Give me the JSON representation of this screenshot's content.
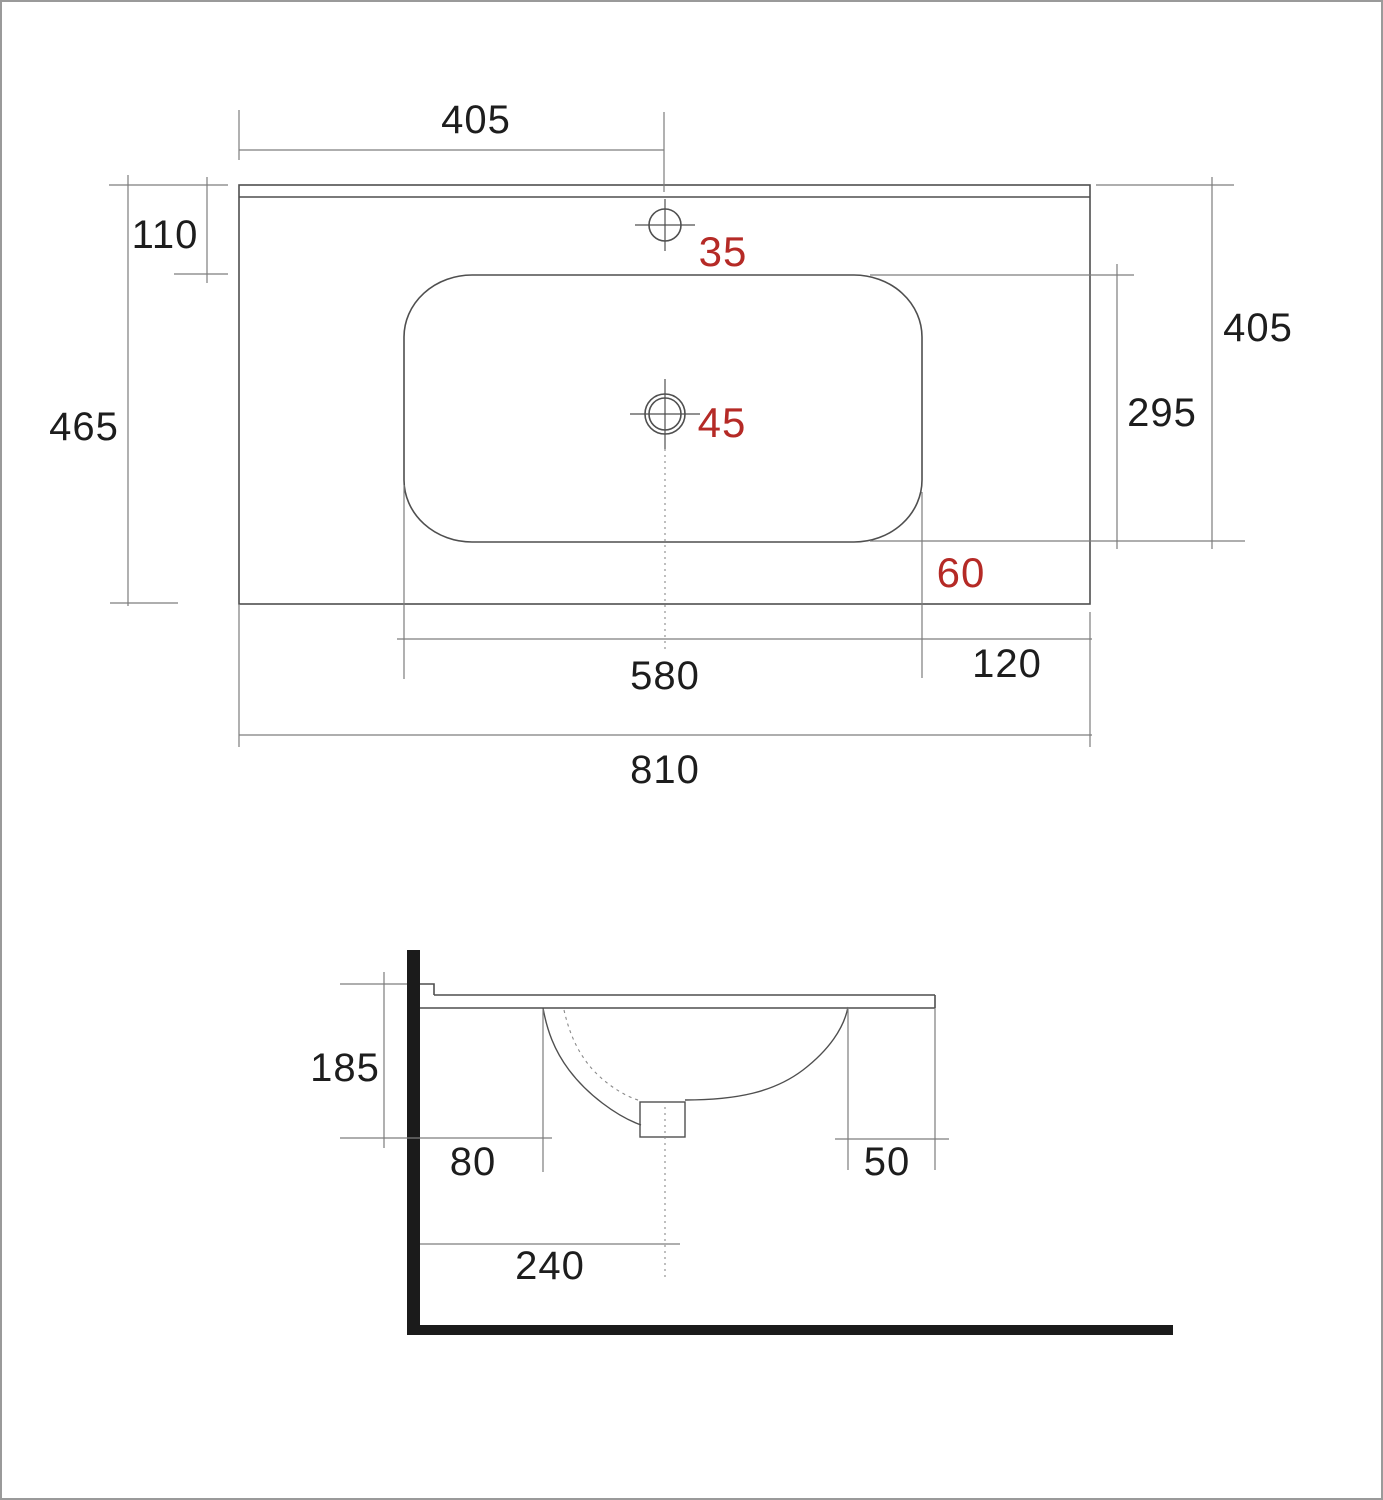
{
  "drawing": {
    "title": "Washbasin technical dimension drawing",
    "views": [
      "top-view",
      "side-section-view"
    ],
    "units_shown": "none (mm implied)"
  },
  "colors": {
    "background": "#ffffff",
    "outline": "#4f4f4f",
    "dimension_line": "#7d7d7d",
    "accent_red": "#b52a26",
    "wall_floor": "#1b1b1b",
    "page_border": "#9a9a9a"
  },
  "top_view": {
    "dims": {
      "faucet_offset": "405",
      "rim_to_basin": "110",
      "total_depth": "465",
      "right_depth": "405",
      "basin_depth": "295",
      "basin_width": "580",
      "basin_to_right_edge": "120",
      "total_width": "810",
      "faucet_hole_diameter": "35",
      "drain_hole_diameter": "45",
      "basin_to_front_edge": "60"
    }
  },
  "side_view": {
    "dims": {
      "basin_height": "185",
      "wall_to_bowl": "80",
      "bowl_to_front_edge": "50",
      "wall_to_drain_center": "240"
    }
  }
}
